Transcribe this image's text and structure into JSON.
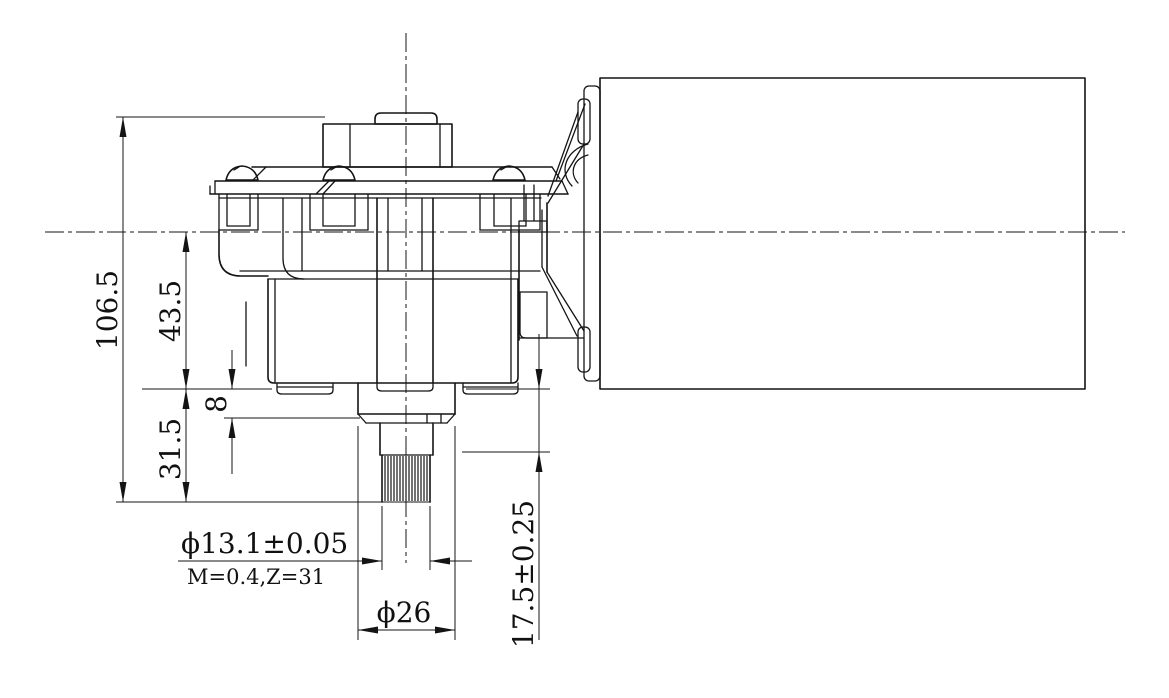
{
  "drawing": {
    "type": "mechanical engineering drawing",
    "subject": "worm gear motor with gearbox and splined output shaft, side elevation",
    "background_color": "#ffffff",
    "line_color": "#141414"
  },
  "dimensions": {
    "overall_height": "106.5",
    "center_to_mount_face": "43.5",
    "mount_face_to_shaft_end": "31.5",
    "boss_height": "8",
    "shaft_shoulder_length": "17.5±0.25",
    "spline_diameter": "ϕ13.1±0.05",
    "spline_spec": "M=0.4,Z=31",
    "collar_diameter": "ϕ26"
  }
}
